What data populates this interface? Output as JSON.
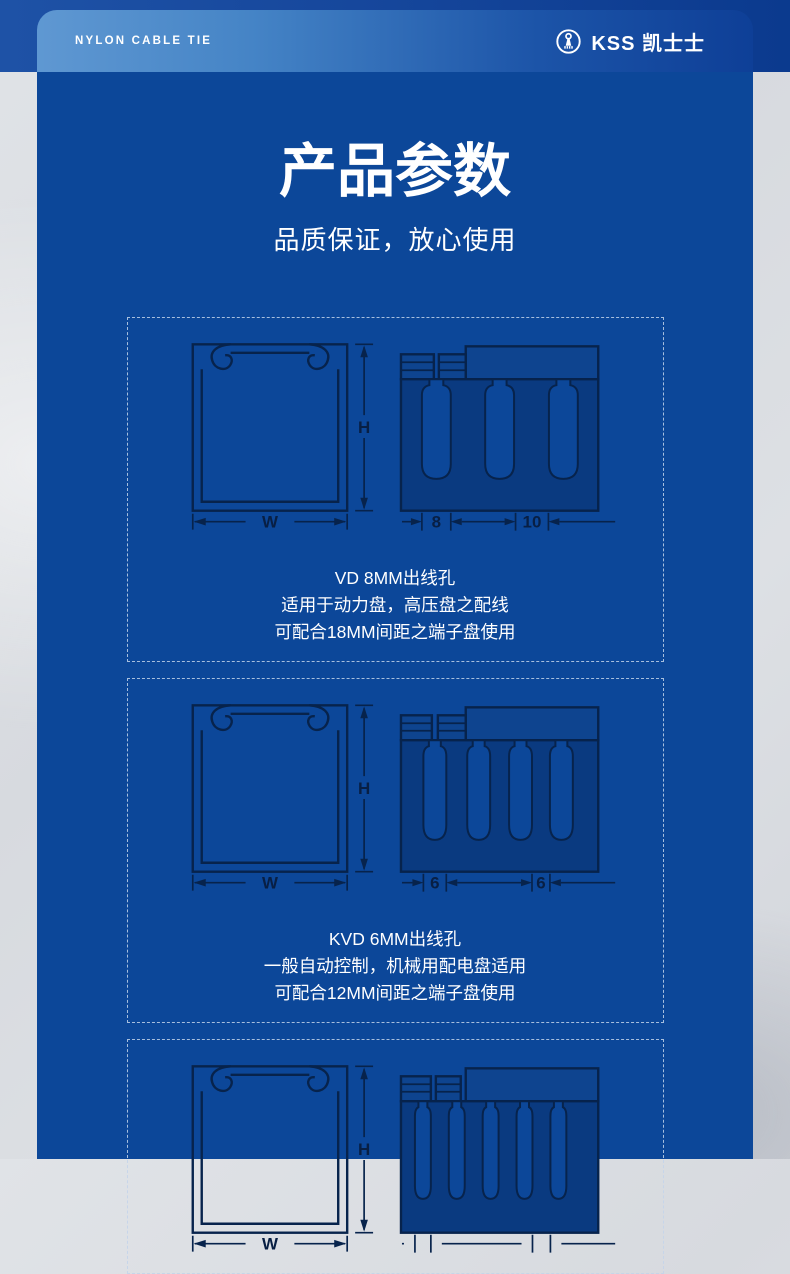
{
  "header": {
    "tagline": "NYLON CABLE TIE",
    "brand": "KSS 凯士士",
    "logo_icon": "kss-circle-cable-tie-logo"
  },
  "hero": {
    "title": "产品参数",
    "subtitle": "品质保证，放心使用"
  },
  "colors": {
    "panel_blue": "#0c4799",
    "band_blue": "#0b3a8e",
    "header_gradient_left": "#5f98d2",
    "header_gradient_right": "#0e3f97",
    "diagram_line": "#07234c",
    "diagram_body_fill": "#0a3a80",
    "diagram_plate_fill": "#0e448f",
    "page_background_gray": "#d7dadf",
    "text_white": "#ffffff"
  },
  "sections": [
    {
      "dim_h": "H",
      "dim_w": "W",
      "dim_a": "8",
      "dim_b": "10",
      "caption": [
        "VD 8MM出线孔",
        "适用于动力盘，高压盘之配线",
        "可配合18MM间距之端子盘使用"
      ]
    },
    {
      "dim_h": "H",
      "dim_w": "W",
      "dim_a": "6",
      "dim_b": "6",
      "caption": [
        "KVD 6MM出线孔",
        "一般自动控制，机械用配电盘适用",
        "可配合12MM间距之端子盘使用"
      ]
    },
    {
      "dim_h": "H",
      "dim_w": "W",
      "dim_a": "",
      "dim_b": "",
      "caption": []
    }
  ]
}
